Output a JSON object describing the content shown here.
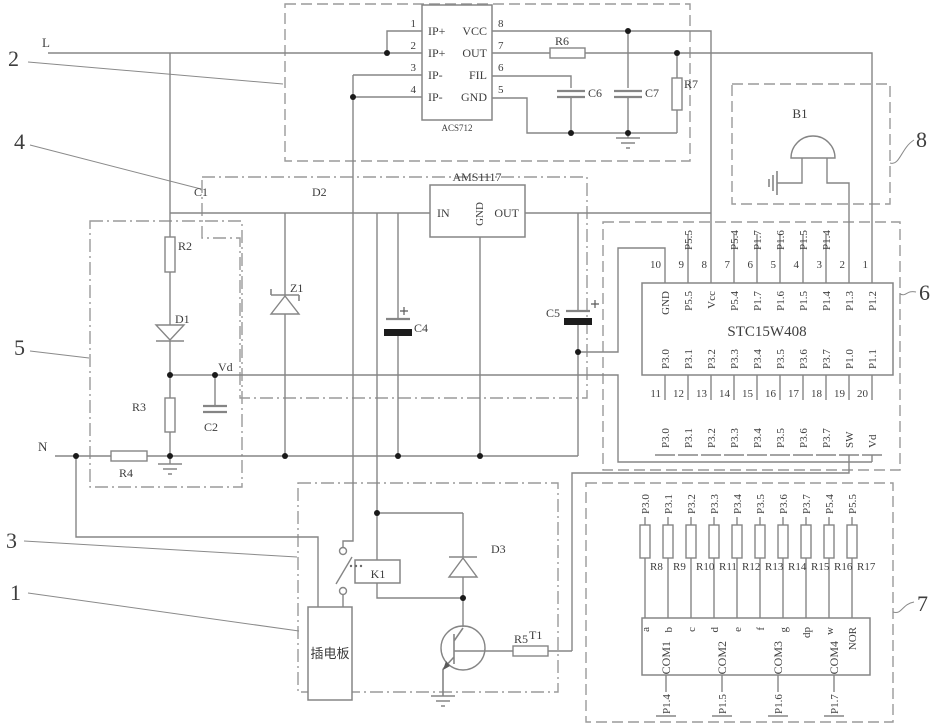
{
  "title": "plug-board power monitoring circuit schematic",
  "nets": {
    "l": "L",
    "n": "N",
    "vd": "Vd"
  },
  "refs": {
    "n1": "1",
    "n2": "2",
    "n3": "3",
    "n4": "4",
    "n5": "5",
    "n6": "6",
    "n7": "7",
    "n8": "8"
  },
  "acs712": {
    "name": "ACS712",
    "left_pins": [
      "IP+",
      "IP+",
      "IP-",
      "IP-"
    ],
    "left_nums": [
      "1",
      "2",
      "3",
      "4"
    ],
    "right_pins": [
      "VCC",
      "OUT",
      "FIL",
      "GND"
    ],
    "right_nums": [
      "8",
      "7",
      "6",
      "5"
    ]
  },
  "sensor_parts": {
    "r6": "R6",
    "r7": "R7",
    "c6": "C6",
    "c7": "C7"
  },
  "regulator": {
    "name": "AMS1117",
    "pin_in": "IN",
    "pin_gnd": "GND",
    "pin_out": "OUT"
  },
  "power_parts": {
    "c1": "C1",
    "d2": "D2",
    "z1": "Z1",
    "c4": "C4",
    "c5": "C5"
  },
  "sampling_parts": {
    "r2": "R2",
    "d1": "D1",
    "r3": "R3",
    "c2": "C2",
    "r4": "R4"
  },
  "relay_parts": {
    "k1": "K1",
    "d3": "D3",
    "t1": "T1",
    "r5": "R5"
  },
  "buzzer": {
    "b1": "B1"
  },
  "plug_board": "插电板",
  "mcu": {
    "name": "STC15W408",
    "top_nums": [
      "10",
      "9",
      "8",
      "7",
      "6",
      "5",
      "4",
      "3",
      "2",
      "1"
    ],
    "top_inside": [
      "GND",
      "P5.5",
      "Vcc",
      "P5.4",
      "P1.7",
      "P1.6",
      "P1.5",
      "P1.4",
      "P1.3",
      "P1.2"
    ],
    "top_ext": [
      "",
      "P5.5",
      "",
      "P5.4",
      "P1.7",
      "P1.6",
      "P1.5",
      "P1.4",
      "",
      ""
    ],
    "bottom_nums": [
      "11",
      "12",
      "13",
      "14",
      "15",
      "16",
      "17",
      "18",
      "19",
      "20"
    ],
    "bottom_inside": [
      "P3.0",
      "P3.1",
      "P3.2",
      "P3.3",
      "P3.4",
      "P3.5",
      "P3.6",
      "P3.7",
      "P1.0",
      "P1.1"
    ],
    "bottom_ext": [
      "P3.0",
      "P3.1",
      "P3.2",
      "P3.3",
      "P3.4",
      "P3.5",
      "P3.6",
      "P3.7",
      "SW",
      "Vd"
    ]
  },
  "display": {
    "top_ext": [
      "P3.0",
      "P3.1",
      "P3.2",
      "P3.3",
      "P3.4",
      "P3.5",
      "P3.6",
      "P3.7",
      "P5.4",
      "P5.5"
    ],
    "resistors": [
      "R8",
      "R9",
      "R10",
      "R11",
      "R12",
      "R13",
      "R14",
      "R15",
      "R16",
      "R17"
    ],
    "segments": [
      "a",
      "b",
      "c",
      "d",
      "e",
      "f",
      "g",
      "dp",
      "w",
      "NOR"
    ],
    "coms": [
      "COM1",
      "COM2",
      "COM3",
      "COM4"
    ],
    "bottom_pins": [
      "P1.4",
      "P1.5",
      "P1.6",
      "P1.7"
    ]
  }
}
